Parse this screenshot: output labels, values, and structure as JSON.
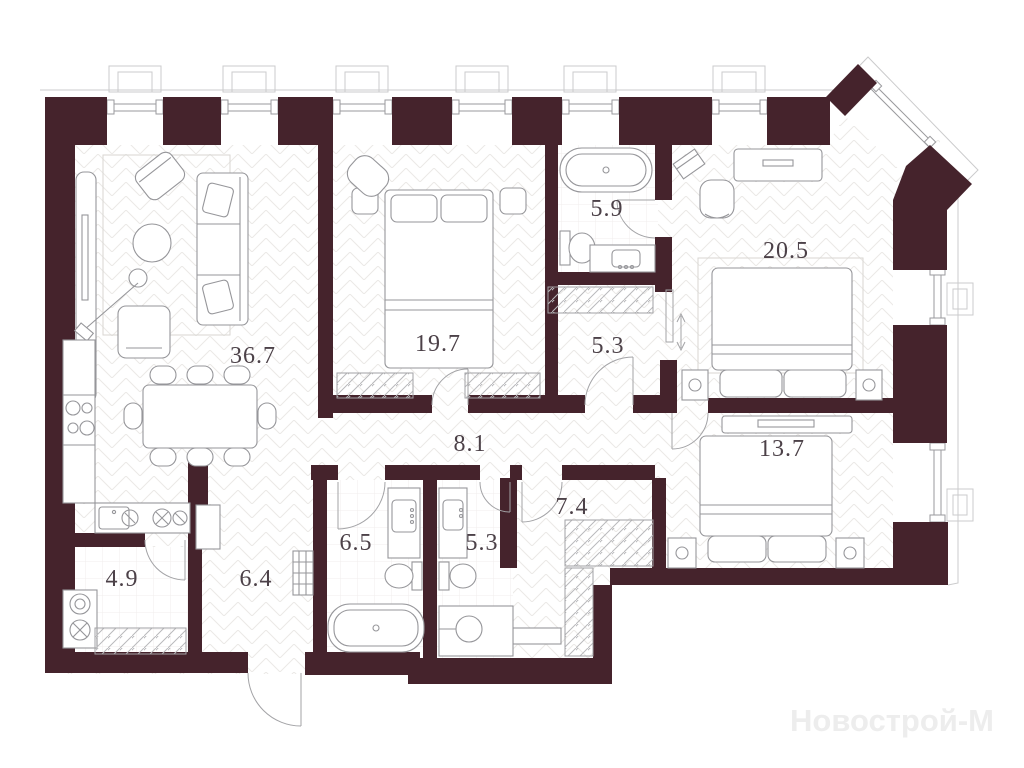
{
  "plan": {
    "watermark": "Новострой-М",
    "rooms": [
      {
        "id": "living-dining-kitchen",
        "area": "36.7"
      },
      {
        "id": "bedroom-1",
        "area": "19.7"
      },
      {
        "id": "bathroom-ensuite",
        "area": "5.9"
      },
      {
        "id": "bedroom-master",
        "area": "20.5"
      },
      {
        "id": "corridor",
        "area": "5.3"
      },
      {
        "id": "hallway",
        "area": "8.1"
      },
      {
        "id": "bedroom-2",
        "area": "13.7"
      },
      {
        "id": "dressing-room",
        "area": "7.4"
      },
      {
        "id": "bathroom-main",
        "area": "6.5"
      },
      {
        "id": "bathroom-guest",
        "area": "5.3"
      },
      {
        "id": "entry-hall",
        "area": "6.4"
      },
      {
        "id": "pantry",
        "area": "4.9"
      }
    ],
    "colors": {
      "wall": "#45232c",
      "furniture_line": "#96969a",
      "label": "#4c4148",
      "watermark": "#ededed",
      "floor_line": "#ebe9e6"
    }
  }
}
